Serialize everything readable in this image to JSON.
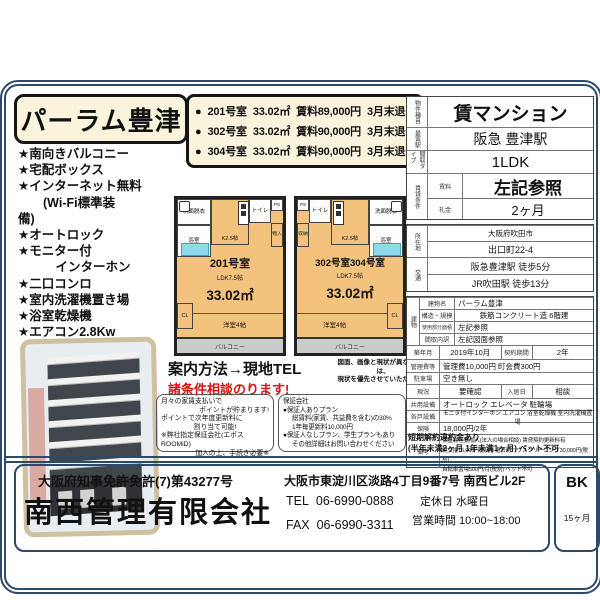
{
  "colors": {
    "border_navy": "#2b4a68",
    "cream": "#fbf4dd",
    "room_orange": "#f3c27c",
    "tub_cyan": "#8fd8ea",
    "red": "#d61414",
    "balcony_gray": "#cbcbcb"
  },
  "title": "パーラム豊津",
  "features": [
    "★南向きバルコニー",
    "★宅配ボックス",
    "★インターネット無料",
    "　　(Wi-Fi標準装",
    "備)",
    "★オートロック",
    "★モニター付",
    "　　　インターホン",
    "★二口コンロ",
    "★室内洗濯機置き場",
    "★浴室乾燥機",
    "★エアコン2.8Kw"
  ],
  "units": [
    {
      "bullet": "●",
      "room": "201号室",
      "area": "33.02㎡",
      "rent": "賃料89,000円",
      "note": "3月末退去"
    },
    {
      "bullet": "●",
      "room": "302号室",
      "area": "33.02㎡",
      "rent": "賃料90,000円",
      "note": "3月末退去"
    },
    {
      "bullet": "●",
      "room": "304号室",
      "area": "33.02㎡",
      "rent": "賃料90,000円",
      "note": "3月末退去"
    }
  ],
  "floorplans": [
    {
      "room_no": "201号室",
      "layout": "LDK7.5帖",
      "area": "33.02㎡",
      "rooms": {
        "washroom": "洗面脱衣",
        "bath": "浴室",
        "kitchen": "K2.5帖",
        "toilet": "トイレ",
        "ps": "PS",
        "storage": "物入",
        "cl": "CL",
        "bedroom": "洋室4帖",
        "balcony": "バルコニー"
      }
    },
    {
      "room_no": "302号室304号室",
      "layout": "LDK7.5帖",
      "area": "33.02㎡",
      "rooms": {
        "washroom": "洗面脱衣",
        "bath": "浴室",
        "kitchen": "K2.5帖",
        "toilet": "トイレ",
        "ps": "PS",
        "storage": "収納",
        "cl": "CL",
        "bedroom": "洋室4帖",
        "balcony": "バルコニー"
      }
    }
  ],
  "guide": {
    "method": "案内方法→現地TEL",
    "negotiable": "諸条件相談のります!"
  },
  "disclaimer": {
    "line1": "図面、画像と現状が異なる場合は、",
    "line2": "現状を優先させていただきます"
  },
  "points_box": {
    "lines": [
      "月々の家賃支払いで",
      "ポイントが貯まります!",
      "ポイントで次年度更新料に",
      "割り当て可能!",
      "※弊社指定保証会社(エポスROOMiD)",
      "加入の上、手続き必要※"
    ]
  },
  "guarantor_box": {
    "title": "保証会社",
    "lines": [
      "●保証人ありプラン",
      "総賃料(家賃、共益費を含む)の30%",
      "1年毎更新料10,000円",
      "●保証人なしプラン、学生プランもあり",
      "その他詳細はお問い合わせください"
    ]
  },
  "spec": {
    "type": {
      "label": "物件種目",
      "value": "賃マンション"
    },
    "station": {
      "label": "最寄駅",
      "value": "阪急 豊津駅"
    },
    "layout": {
      "label": "間取タイプ",
      "value": "1LDK"
    },
    "terms": {
      "label": "賃貸条件",
      "rent_label": "賃料",
      "rent": "左記参照",
      "key_label": "礼金",
      "key": "2ヶ月"
    },
    "address": {
      "label": "所在地",
      "line1": "大阪府吹田市",
      "line2": "出口町22-4"
    },
    "access": {
      "label": "交通",
      "line1": "阪急豊津駅 徒歩5分",
      "line2": "JR吹田駅 徒歩13分"
    },
    "building": {
      "label": "建物",
      "name_label": "建物名",
      "name": "パーラム豊津",
      "structure_label": "構造・規模",
      "structure": "鉄筋コンクリート造 6階建",
      "area_label": "使用部分面積",
      "area": "左記参照",
      "madori_label": "間取内訳",
      "madori": "左記図面参照"
    },
    "built": {
      "label": "築年月",
      "value": "2019年10月",
      "term_label": "契約期間",
      "term": "2年"
    },
    "fees": {
      "label": "管理費等",
      "value": "管理費10,000円 町会費300円"
    },
    "parking": {
      "label": "駐車場",
      "value": "空き無し"
    },
    "status": {
      "label": "現況",
      "value": "要確認",
      "movein_label": "入居日",
      "movein": "相談"
    },
    "shared": {
      "label": "共用設備",
      "value": "オートロック エレベータ 駐輪場"
    },
    "unit_equip": {
      "label": "各戸設備",
      "value": "モニタ付インターホン エアコン 浴室乾燥機 室内洗濯機置場"
    },
    "insurance": {
      "label": "保険",
      "value": "18,000円/2年"
    },
    "notes": {
      "label": "備考",
      "lines": [
        "保証会社要加入(法人の場合相談) 賃貸契約更新料有",
        "鍵交換15,000円(税別) 退去時ハウスクリーニング30,000円(税別)",
        "自転車置場500円/月(税別) ペット不可"
      ]
    },
    "short_term": {
      "line1": "短期解約違約金あり",
      "line2": "(半年未満2ヶ月 1年未満1ヶ月) ペット不可"
    }
  },
  "footer": {
    "license": "大阪府知事免許免許(7)第43277号",
    "company": "南西管理有限会社",
    "address": "大阪市東淀川区淡路4丁目9番7号  南西ビル2F",
    "tel_label": "TEL",
    "tel": "06-6990-0888",
    "fax_label": "FAX",
    "fax": "06-6990-3311",
    "closed": "定休日  水曜日",
    "hours": "営業時間  10:00~18:00",
    "bk": "BK",
    "bk_sub": "15ヶ月"
  }
}
